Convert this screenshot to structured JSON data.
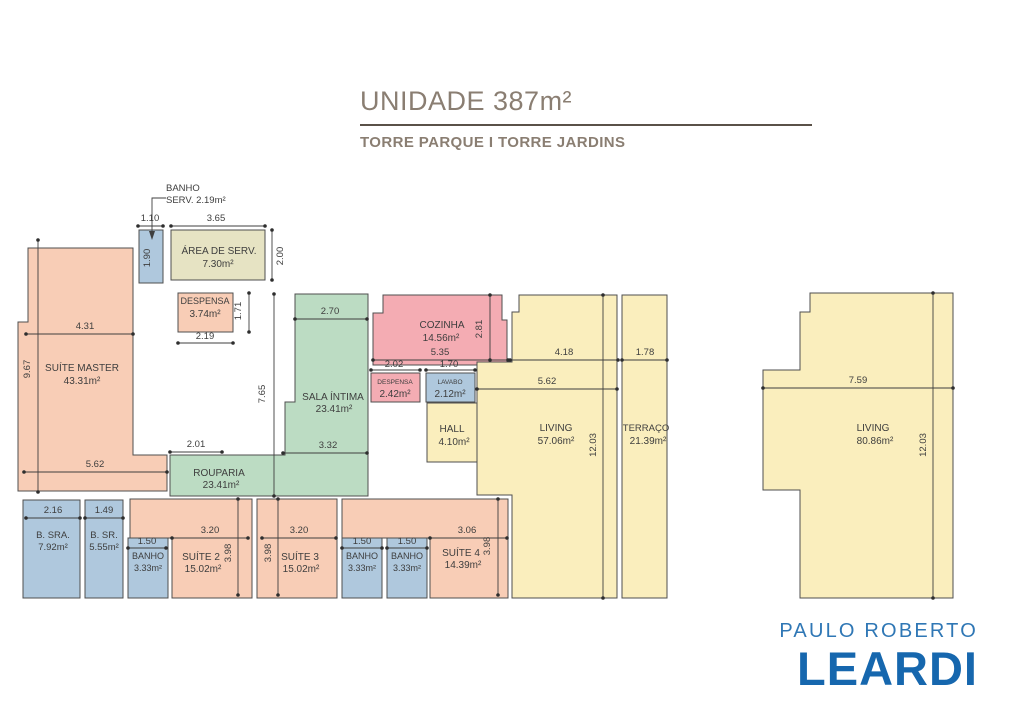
{
  "header": {
    "title": "UNIDADE 387m²",
    "subtitle": "TORRE PARQUE I TORRE JARDINS"
  },
  "callout": {
    "line1": "BANHO",
    "line2": "SERV. 2.19m²"
  },
  "rooms": [
    {
      "name": "ÁREA DE SERV.",
      "area": "7.30m²"
    },
    {
      "name": "DESPENSA",
      "area": "3.74m²"
    },
    {
      "name": "SUÍTE MASTER",
      "area": "43.31m²"
    },
    {
      "name": "SALA ÍNTIMA",
      "area": "23.41m²"
    },
    {
      "name": "ROUPARIA",
      "area": "23.41m²"
    },
    {
      "name": "COZINHA",
      "area": "14.56m²"
    },
    {
      "name": "DESPENSA",
      "area": "2.42m²"
    },
    {
      "name": "LAVABO",
      "area": "2.12m²"
    },
    {
      "name": "HALL",
      "area": "4.10m²"
    },
    {
      "name": "LIVING",
      "area": "57.06m²"
    },
    {
      "name": "TERRAÇO",
      "area": "21.39m²"
    },
    {
      "name": "LIVING",
      "area": "80.86m²"
    },
    {
      "name": "B. SRA.",
      "area": "7.92m²"
    },
    {
      "name": "B. SR.",
      "area": "5.55m²"
    },
    {
      "name": "BANHO",
      "area": "3.33m²"
    },
    {
      "name": "SUÍTE 2",
      "area": "15.02m²"
    },
    {
      "name": "SUÍTE 3",
      "area": "15.02m²"
    },
    {
      "name": "BANHO",
      "area": "3.33m²"
    },
    {
      "name": "BANHO",
      "area": "3.33m²"
    },
    {
      "name": "SUÍTE 4",
      "area": "14.39m²"
    }
  ],
  "dims": [
    "1.10",
    "3.65",
    "1.90",
    "2.00",
    "1.71",
    "2.19",
    "4.31",
    "9.67",
    "5.62",
    "2.70",
    "7.65",
    "3.32",
    "2.01",
    "2.81",
    "5.35",
    "2.02",
    "1.70",
    "4.18",
    "1.78",
    "5.62",
    "12.03",
    "7.59",
    "12.03",
    "2.16",
    "1.49",
    "1.50",
    "3.20",
    "3.98",
    "3.20",
    "3.98",
    "1.50",
    "1.50",
    "3.06",
    "3.98"
  ],
  "logo": {
    "line1": "PAULO ROBERTO",
    "line2": "LEARDI"
  },
  "colors": {
    "salmon": "#f8cdb6",
    "pink": "#f4acb3",
    "green": "#bcdcc3",
    "yellow": "#faeebd",
    "blue": "#afc8dd",
    "beige": "#e6e3c3",
    "title_taupe": "#8a7e72",
    "logo_light_blue": "#2f77b5",
    "logo_dark_blue": "#1667ae",
    "wall": "#4f4f4f"
  }
}
